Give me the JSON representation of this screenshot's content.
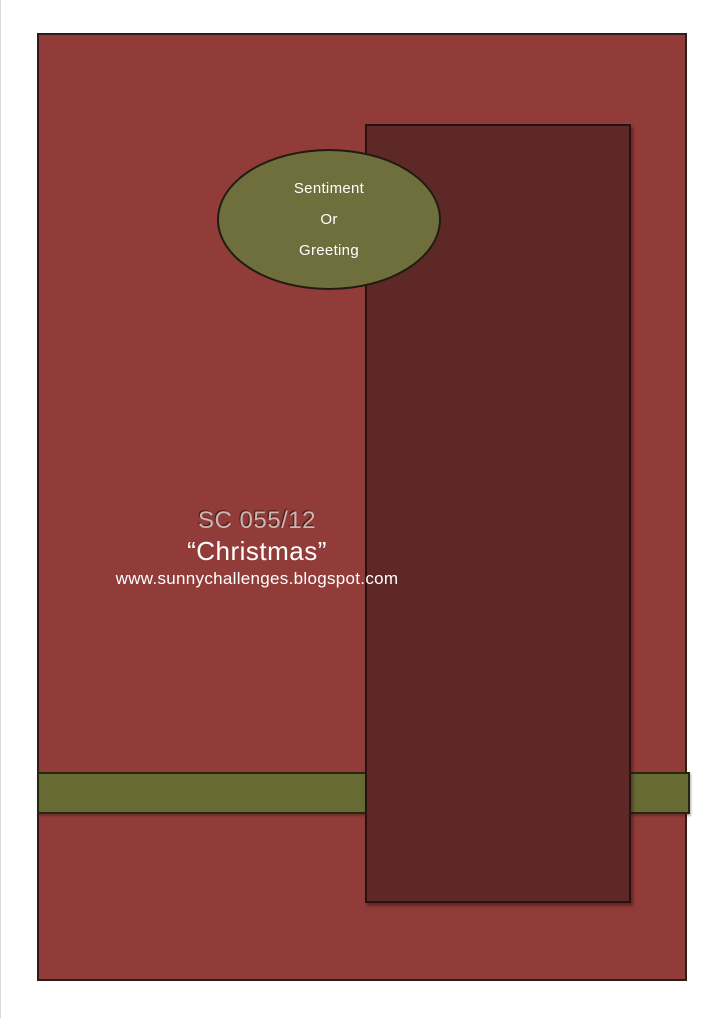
{
  "page": {
    "background": "#ffffff"
  },
  "card": {
    "background_color": "#923c39",
    "border_color": "#2f1b19"
  },
  "dark_panel": {
    "background_color": "#5d2826",
    "border_color": "#271211"
  },
  "accent_bar": {
    "background_color": "#676b33",
    "border_color": "#25270f"
  },
  "sentiment_ellipse": {
    "background_color": "#6e6f3c",
    "border_color": "#201c10",
    "text_color": "#ffffff",
    "lines": [
      "Sentiment",
      "Or",
      "Greeting"
    ]
  },
  "title_block": {
    "challenge_code": "SC 055/12",
    "challenge_code_color": "#ccb6b3",
    "theme": "“Christmas”",
    "theme_color": "#ffffff",
    "url": "www.sunnychallenges.blogspot.com",
    "url_color": "#ffffff"
  }
}
